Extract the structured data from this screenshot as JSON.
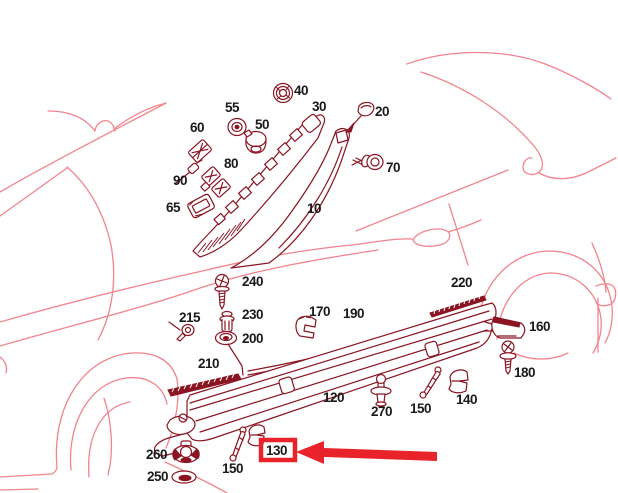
{
  "diagram": {
    "kind": "exploded-parts-diagram",
    "subject": "car side sill / pillar trim",
    "colors": {
      "car_outline": "#f2848e",
      "part_lines": "#8b1422",
      "label_text": "#1a1a1a",
      "highlight_red": "#e8232a"
    },
    "highlight": {
      "boxed_part": "130",
      "arrow_direction": "left"
    },
    "parts": {
      "p10": "10",
      "p20": "20",
      "p30": "30",
      "p40": "40",
      "p50": "50",
      "p55": "55",
      "p60": "60",
      "p65": "65",
      "p70": "70",
      "p80": "80",
      "p90": "90",
      "p120": "120",
      "p130": "130",
      "p140": "140",
      "p150a": "150",
      "p150b": "150",
      "p160": "160",
      "p170": "170",
      "p180": "180",
      "p190": "190",
      "p200": "200",
      "p210": "210",
      "p215": "215",
      "p220": "220",
      "p230": "230",
      "p240": "240",
      "p250": "250",
      "p260": "260",
      "p270": "270"
    }
  }
}
